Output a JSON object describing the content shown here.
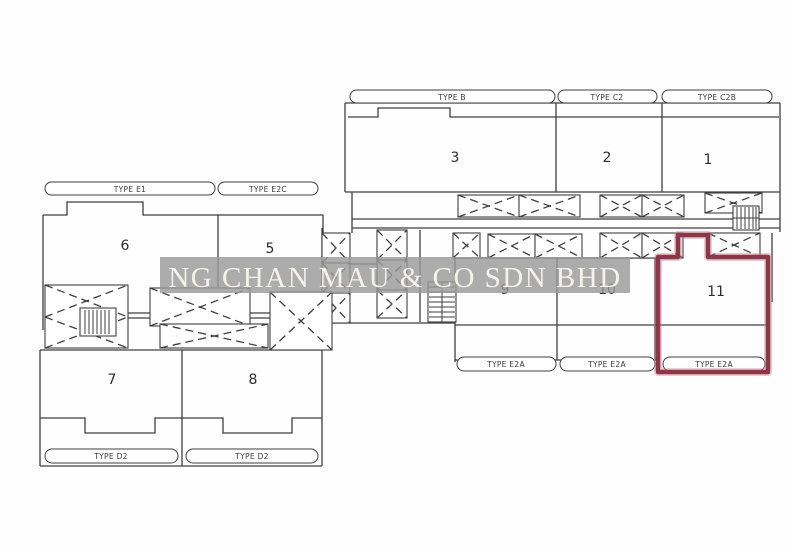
{
  "watermark": {
    "text": "NG CHAN MAU & CO SDN BHD"
  },
  "units": {
    "u1": "1",
    "u2": "2",
    "u3": "3",
    "u5": "5",
    "u6": "6",
    "u7": "7",
    "u8": "8",
    "u9": "9",
    "u10": "10",
    "u11": "11"
  },
  "labels": {
    "type_b": "TYPE B",
    "type_c2": "TYPE C2",
    "type_c2b": "TYPE C2B",
    "type_e1": "TYPE E1",
    "type_e2c": "TYPE E2C",
    "type_e2a_1": "TYPE E2A",
    "type_e2a_2": "TYPE E2A",
    "type_e2a_3": "TYPE E2A",
    "type_d2_1": "TYPE D2",
    "type_d2_2": "TYPE D2"
  },
  "colors": {
    "highlight": "#8e3647",
    "highlight_halo": "#c98f9b",
    "watermark_band": "#9a9a9a",
    "watermark_text": "#faf8f4"
  }
}
